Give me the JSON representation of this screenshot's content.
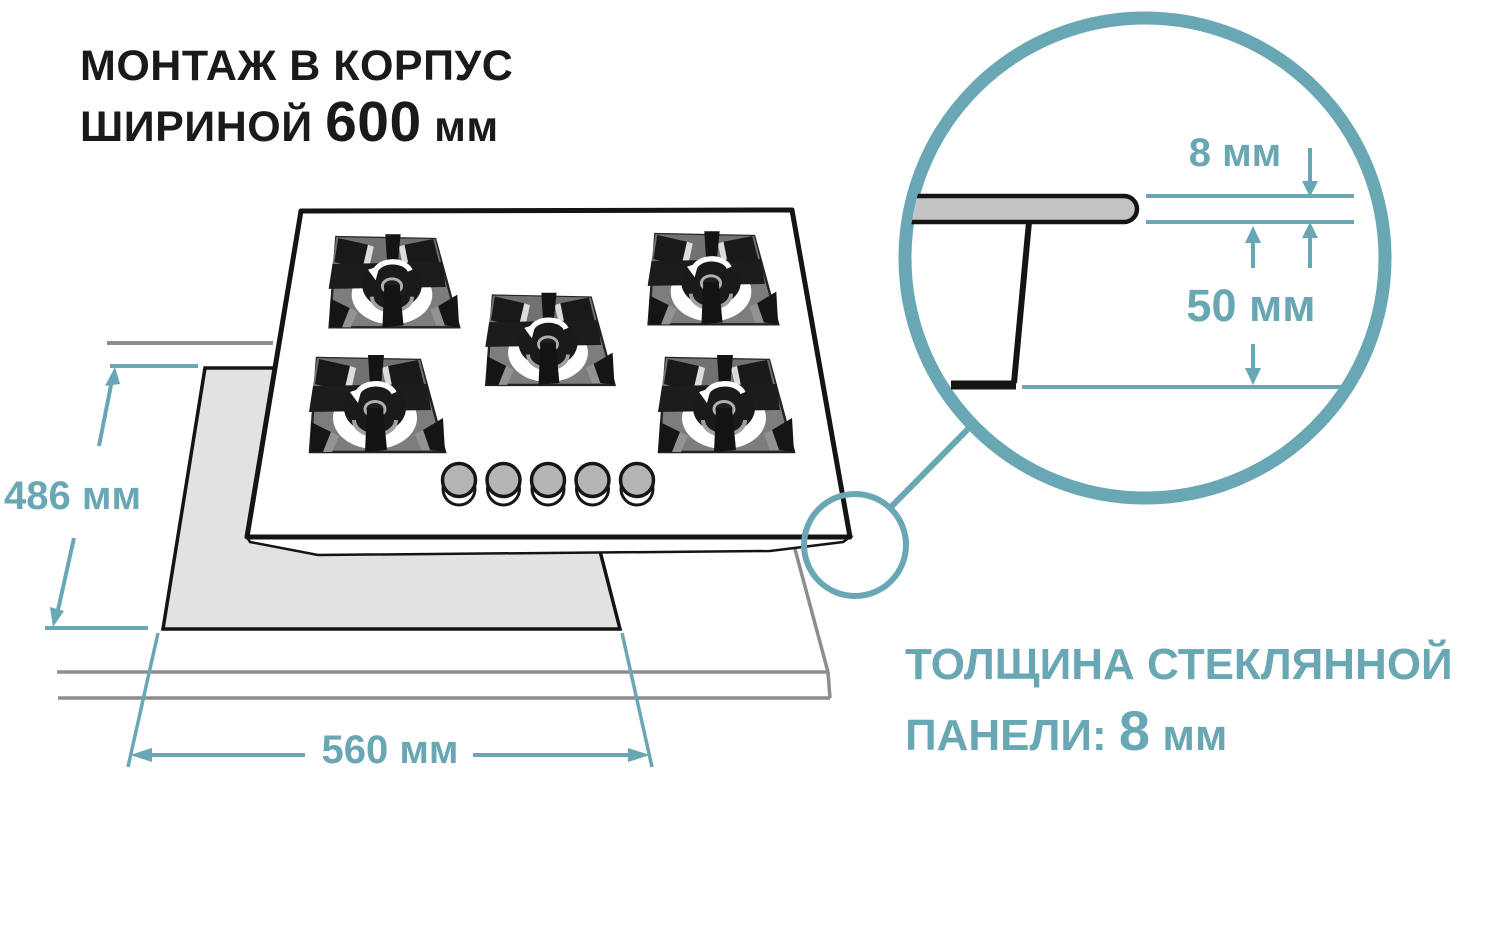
{
  "title": {
    "line1": "МОНТАЖ В КОРПУС",
    "line2_prefix": "ШИРИНОЙ",
    "line2_value": "600",
    "line2_unit": "мм"
  },
  "dimensions": {
    "cutout_depth": "486 мм",
    "cutout_width": "560 мм",
    "glass_thickness": "8 мм",
    "mount_depth": "50 мм"
  },
  "caption": {
    "line1": "ТОЛЩИНА СТЕКЛЯННОЙ",
    "line2_prefix": "ПАНЕЛИ:",
    "line2_value": "8",
    "line2_unit": "мм"
  },
  "colors": {
    "accent": "#68a7b3",
    "outline": "#141414",
    "countertop_line": "#8d8d8d",
    "cutout_fill": "#e2e2e2",
    "glass_fill": "#c3c3c3"
  }
}
